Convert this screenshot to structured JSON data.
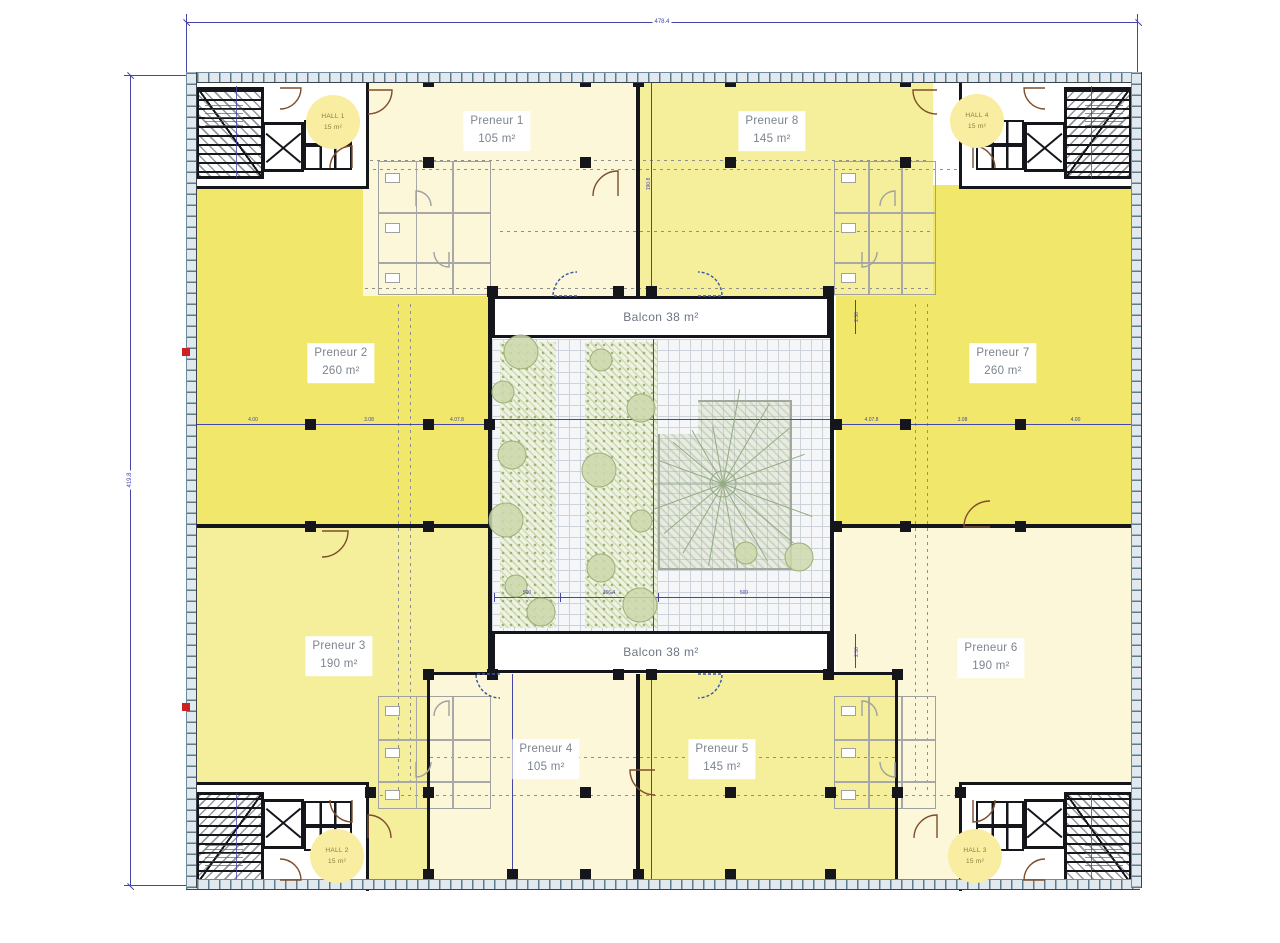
{
  "plan": {
    "units": [
      {
        "name": "Preneur 1",
        "area": "105 m²"
      },
      {
        "name": "Preneur 2",
        "area": "260 m²"
      },
      {
        "name": "Preneur 3",
        "area": "190 m²"
      },
      {
        "name": "Preneur 4",
        "area": "105 m²"
      },
      {
        "name": "Preneur 5",
        "area": "145 m²"
      },
      {
        "name": "Preneur 6",
        "area": "190 m²"
      },
      {
        "name": "Preneur 7",
        "area": "260 m²"
      },
      {
        "name": "Preneur 8",
        "area": "145 m²"
      }
    ],
    "balconies": [
      {
        "label": "Balcon 38 m²"
      },
      {
        "label": "Balcon 38 m²"
      }
    ],
    "halls": [
      {
        "name": "HALL 1",
        "area": "15 m²"
      },
      {
        "name": "HALL 2",
        "area": "15 m²"
      },
      {
        "name": "HALL 3",
        "area": "15 m²"
      },
      {
        "name": "HALL 4",
        "area": "15 m²"
      }
    ],
    "dimensions": {
      "overall_width": "478.4",
      "overall_height": "419.8",
      "axis_label": "190.8",
      "balcony_depth": "2.50",
      "chain_left": [
        "4.00",
        "3.08",
        "4.07.8"
      ],
      "chain_right": [
        "4.07.8",
        "3.08",
        "4.00"
      ],
      "chain_court": [
        "500",
        "366.4",
        "500"
      ]
    },
    "colors": {
      "yellow_bright": "#f1e76b",
      "yellow_medium": "#f5ee9b",
      "pale_cream": "#fbf7d8",
      "hall_badge": "#f8eda1",
      "wall_black": "#14161c",
      "dimension_blue": "#4646aa",
      "frame_blue_gray": "#5d7b8d",
      "sanitary_gray": "#a0a0a0",
      "door_brown": "#7d4e2d",
      "vegetation_green": "#9db077"
    }
  }
}
